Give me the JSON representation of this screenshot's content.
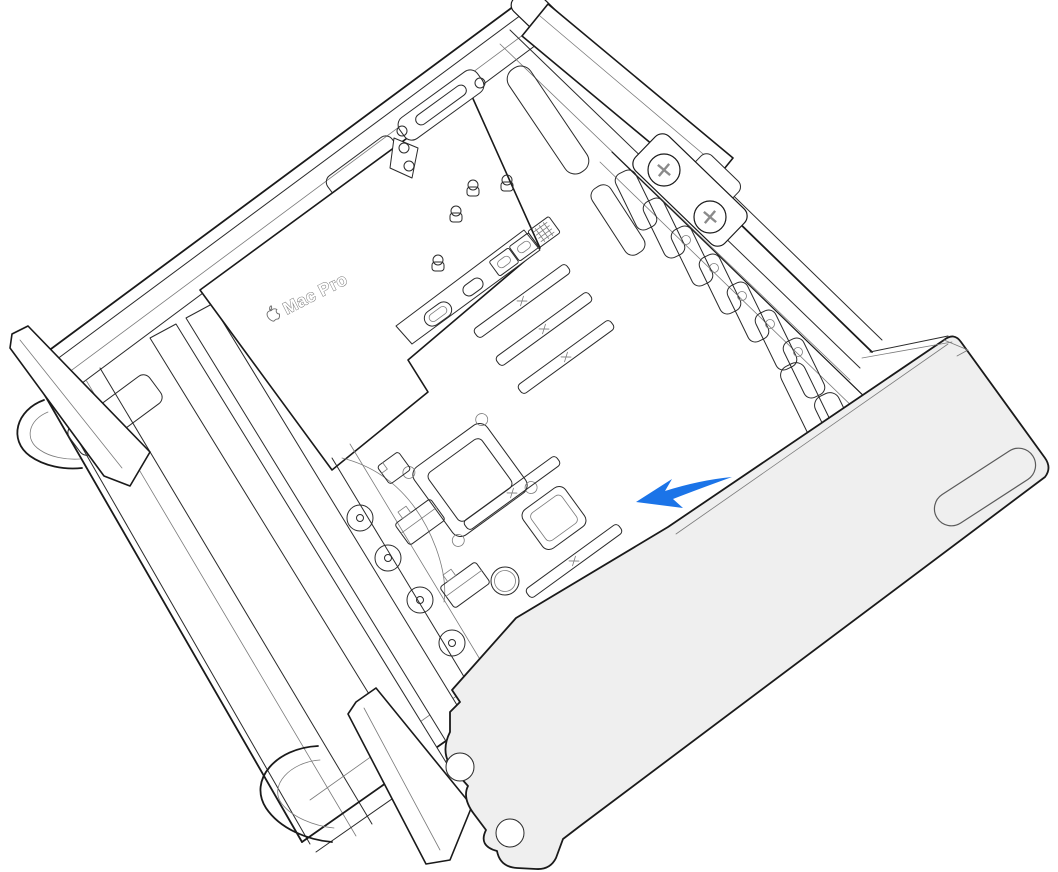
{
  "illustration": {
    "device_label": "Mac Pro",
    "colors": {
      "background": "#ffffff",
      "line": "#1a1a1a",
      "line_light": "#7a7a7a",
      "panel_fill": "#efefef",
      "arrow_blue": "#1b74e8",
      "logo_outline": "#6e6e6e"
    }
  }
}
